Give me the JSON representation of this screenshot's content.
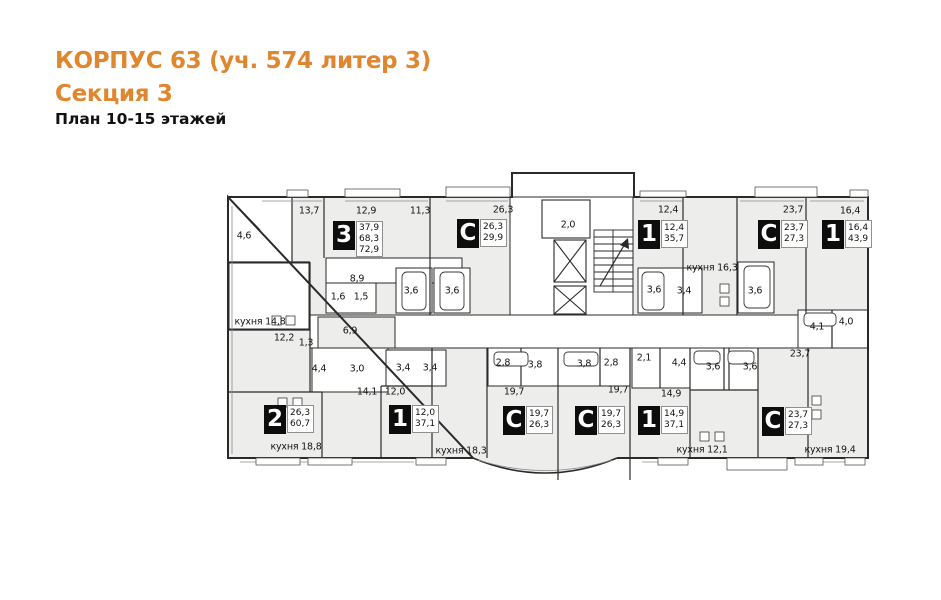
{
  "header": {
    "building": "КОРПУС 63 (уч. 574 литер 3)",
    "section": "Секция 3",
    "plan": "План 10-15 этажей"
  },
  "colors": {
    "accent": "#e0862e",
    "wall": "#2a2a2a",
    "room_fill": "#edeeec",
    "corridor_fill": "#ffffff"
  },
  "plan": {
    "apartments": [
      {
        "type": "3",
        "areas": [
          "37,9",
          "68,3",
          "72,9"
        ],
        "x": 333,
        "y": 221
      },
      {
        "type": "С",
        "areas": [
          "26,3",
          "29,9"
        ],
        "x": 457,
        "y": 219
      },
      {
        "type": "1",
        "areas": [
          "12,4",
          "35,7"
        ],
        "x": 638,
        "y": 220
      },
      {
        "type": "С",
        "areas": [
          "23,7",
          "27,3"
        ],
        "x": 758,
        "y": 220
      },
      {
        "type": "1",
        "areas": [
          "16,4",
          "43,9"
        ],
        "x": 822,
        "y": 220
      },
      {
        "type": "2",
        "areas": [
          "26,3",
          "60,7"
        ],
        "x": 264,
        "y": 405
      },
      {
        "type": "1",
        "areas": [
          "12,0",
          "37,1"
        ],
        "x": 389,
        "y": 405
      },
      {
        "type": "С",
        "areas": [
          "19,7",
          "26,3"
        ],
        "x": 503,
        "y": 406
      },
      {
        "type": "С",
        "areas": [
          "19,7",
          "26,3"
        ],
        "x": 575,
        "y": 406
      },
      {
        "type": "1",
        "areas": [
          "14,9",
          "37,1"
        ],
        "x": 638,
        "y": 406
      },
      {
        "type": "С",
        "areas": [
          "23,7",
          "27,3"
        ],
        "x": 762,
        "y": 407
      }
    ],
    "rooms": [
      {
        "label": "4,6",
        "x": 244,
        "y": 236
      },
      {
        "label": "13,7",
        "x": 309,
        "y": 211
      },
      {
        "label": "12,9",
        "x": 366,
        "y": 211
      },
      {
        "label": "11,3",
        "x": 420,
        "y": 211
      },
      {
        "label": "26,3",
        "x": 503,
        "y": 210
      },
      {
        "label": "2,0",
        "x": 568,
        "y": 225
      },
      {
        "label": "12,4",
        "x": 668,
        "y": 210
      },
      {
        "label": "23,7",
        "x": 793,
        "y": 210
      },
      {
        "label": "16,4",
        "x": 850,
        "y": 211
      },
      {
        "label": "8,9",
        "x": 357,
        "y": 279
      },
      {
        "label": "1,6",
        "x": 338,
        "y": 297
      },
      {
        "label": "1,5",
        "x": 361,
        "y": 297
      },
      {
        "label": "3,6",
        "x": 411,
        "y": 291
      },
      {
        "label": "3,6",
        "x": 452,
        "y": 291
      },
      {
        "label": "3,6",
        "x": 654,
        "y": 290
      },
      {
        "label": "3,4",
        "x": 684,
        "y": 291
      },
      {
        "label": "кухня 16,3",
        "x": 712,
        "y": 268
      },
      {
        "label": "3,6",
        "x": 755,
        "y": 291
      },
      {
        "label": "4,1",
        "x": 817,
        "y": 327
      },
      {
        "label": "4,0",
        "x": 846,
        "y": 322
      },
      {
        "label": "кухня 14,8",
        "x": 260,
        "y": 322
      },
      {
        "label": "12,2",
        "x": 284,
        "y": 338
      },
      {
        "label": "1,3",
        "x": 306,
        "y": 343
      },
      {
        "label": "6,9",
        "x": 350,
        "y": 331
      },
      {
        "label": "4,4",
        "x": 319,
        "y": 369
      },
      {
        "label": "3,0",
        "x": 357,
        "y": 369
      },
      {
        "label": "3,4",
        "x": 403,
        "y": 368
      },
      {
        "label": "3,4",
        "x": 430,
        "y": 368
      },
      {
        "label": "14,1",
        "x": 367,
        "y": 392
      },
      {
        "label": "12,0",
        "x": 395,
        "y": 392
      },
      {
        "label": "2,8",
        "x": 503,
        "y": 363
      },
      {
        "label": "3,8",
        "x": 535,
        "y": 365
      },
      {
        "label": "3,8",
        "x": 584,
        "y": 364
      },
      {
        "label": "2,8",
        "x": 611,
        "y": 363
      },
      {
        "label": "19,7",
        "x": 514,
        "y": 392
      },
      {
        "label": "19,7",
        "x": 618,
        "y": 390
      },
      {
        "label": "2,1",
        "x": 644,
        "y": 358
      },
      {
        "label": "4,4",
        "x": 679,
        "y": 363
      },
      {
        "label": "14,9",
        "x": 671,
        "y": 394
      },
      {
        "label": "3,6",
        "x": 713,
        "y": 367
      },
      {
        "label": "3,6",
        "x": 750,
        "y": 367
      },
      {
        "label": "23,7",
        "x": 800,
        "y": 354
      },
      {
        "label": "кухня 18,8",
        "x": 296,
        "y": 447
      },
      {
        "label": "кухня 18,3",
        "x": 461,
        "y": 451
      },
      {
        "label": "кухня 12,1",
        "x": 702,
        "y": 450
      },
      {
        "label": "кухня 19,4",
        "x": 830,
        "y": 450
      }
    ]
  }
}
